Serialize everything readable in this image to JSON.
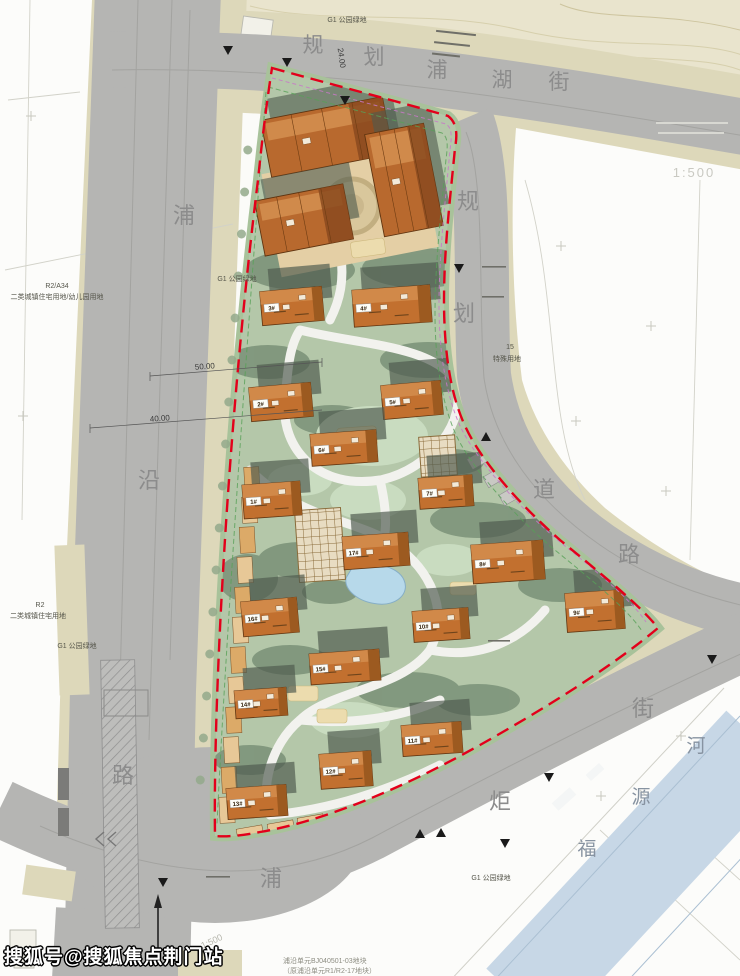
{
  "map": {
    "streets": {
      "top": {
        "name": "规划浦湖街"
      },
      "left": {
        "name": "浦沿路"
      },
      "right": {
        "name": "规划道路"
      },
      "bottom": {
        "name": "浦炬街"
      },
      "river": {
        "name": "福源河"
      }
    },
    "area_labels": [
      {
        "text": "G1 公园绿地"
      },
      {
        "text": "R2/A34"
      },
      {
        "text": "二类城镇住宅用地/幼儿园用地"
      },
      {
        "text": "G1 公园绿地"
      },
      {
        "text": "R2"
      },
      {
        "text": "二类城镇住宅用地"
      },
      {
        "text": "G1 公园绿地"
      },
      {
        "text": "15"
      },
      {
        "text": "特殊用地"
      },
      {
        "text": "G1 公园绿地"
      }
    ],
    "annotations": {
      "scale": "1:500",
      "scale_secondary": "1:500",
      "width_top": "24.00",
      "width_50": "50.00",
      "width_40": "40.00",
      "note_line1": "浦沿单元BJ040501-03地块",
      "note_line2": "（原浦沿单元R1/R2-17地块）"
    },
    "buildings": [
      "1#",
      "2#",
      "3#",
      "4#",
      "5#",
      "6#",
      "7#",
      "8#",
      "9#",
      "10#",
      "11#",
      "12#",
      "13#",
      "14#",
      "15#",
      "16#",
      "17#"
    ],
    "legend_colors": {
      "residential_building": "#c2702f",
      "site_green": "#b4c7a9",
      "road_gray": "#b5b5b3",
      "buffer_beige": "#ddd8ba",
      "river_blue": "#c7d7e6",
      "boundary_red": "#e3001b"
    }
  },
  "watermark": "搜狐号@搜狐焦点荆门站"
}
